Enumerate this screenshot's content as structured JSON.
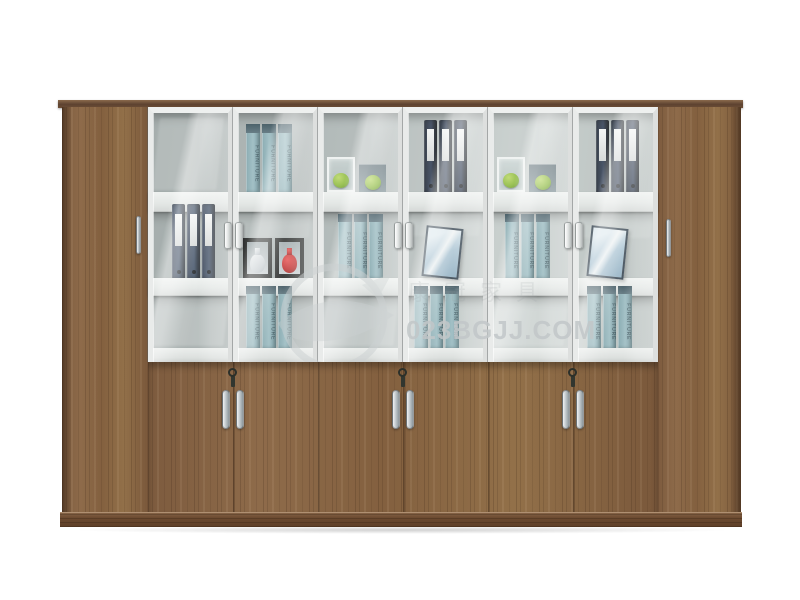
{
  "scene": {
    "description": "Walnut office wall cabinet with white-framed glass display doors, full-height wooden side doors, lower wooden double-door cupboards and a plinth base, photographed on a white background",
    "background_color": "#ffffff"
  },
  "watermark": {
    "site_text": "023BGJJ.COM",
    "cn_text": "康冠家具",
    "logo": "swoosh-circle-logo",
    "color": "#c2c7c9"
  },
  "labels": {
    "box_spine": "FURNITURE"
  },
  "colors": {
    "wood": "#86633f",
    "wood_dark": "#5d4230",
    "frame_white": "#eef0ef",
    "glass_tint": "#d0dad9",
    "interior_back": "#aab1b1",
    "binder_navy": "#202b42",
    "binder_black": "#131a28",
    "box_teal": "#87aab2",
    "apple_green": "#8cbb35",
    "vase_red": "#c02020",
    "vase_white": "#f4f6f8",
    "chrome": "#c2c9cd"
  },
  "structure": {
    "glass_door_bounds": [
      148,
      233,
      318,
      403,
      488,
      573,
      658
    ],
    "glass_handle_seams": [
      233,
      403,
      573
    ],
    "bottom_handle_seams": [
      233,
      403,
      573
    ],
    "wood_seams": [
      233,
      318,
      403,
      488,
      573
    ],
    "side_handles": [
      {
        "x": 136,
        "y": 216
      },
      {
        "x": 666,
        "y": 219
      }
    ],
    "shelf_rows": 3,
    "glass_doors": 6,
    "lower_door_pairs": 3
  },
  "items": [
    {
      "type": "boxes",
      "n": 3,
      "x": 246,
      "y": 124,
      "w": 46,
      "h": 68
    },
    {
      "type": "cup-apple",
      "x": 327,
      "y": 157,
      "w": 28,
      "h": 35
    },
    {
      "type": "coaster-apple",
      "x": 359,
      "y": 164,
      "w": 27,
      "h": 28
    },
    {
      "type": "binders",
      "variant": "black",
      "x": 424,
      "y": 120,
      "w": 43,
      "h": 72
    },
    {
      "type": "cup-apple",
      "x": 497,
      "y": 157,
      "w": 28,
      "h": 35
    },
    {
      "type": "coaster-apple",
      "x": 529,
      "y": 164,
      "w": 27,
      "h": 28
    },
    {
      "type": "binders",
      "variant": "black",
      "x": 596,
      "y": 120,
      "w": 43,
      "h": 72
    },
    {
      "type": "binders",
      "variant": "navy",
      "x": 172,
      "y": 204,
      "w": 43,
      "h": 74
    },
    {
      "type": "vase",
      "variant": "white",
      "x": 243,
      "y": 238,
      "w": 29,
      "h": 40
    },
    {
      "type": "vase",
      "variant": "red",
      "x": 275,
      "y": 238,
      "w": 29,
      "h": 40
    },
    {
      "type": "boxes",
      "n": 3,
      "x": 338,
      "y": 214,
      "w": 45,
      "h": 64
    },
    {
      "type": "frame",
      "x": 424,
      "y": 227,
      "w": 37,
      "h": 51
    },
    {
      "type": "boxes",
      "n": 3,
      "x": 505,
      "y": 214,
      "w": 45,
      "h": 64
    },
    {
      "type": "frame",
      "x": 589,
      "y": 227,
      "w": 37,
      "h": 51
    },
    {
      "type": "boxes",
      "n": 3,
      "x": 246,
      "y": 286,
      "w": 46,
      "h": 62
    },
    {
      "type": "boxes",
      "n": 3,
      "x": 414,
      "y": 286,
      "w": 45,
      "h": 62
    },
    {
      "type": "boxes",
      "n": 3,
      "x": 587,
      "y": 286,
      "w": 45,
      "h": 62
    }
  ],
  "reflections": [
    {
      "x": 156,
      "y": 118,
      "w": 64,
      "h": 72,
      "o": 0.38
    },
    {
      "x": 154,
      "y": 298,
      "w": 72,
      "h": 48,
      "o": 0.5
    },
    {
      "x": 324,
      "y": 298,
      "w": 72,
      "h": 48,
      "o": 0.45
    },
    {
      "x": 494,
      "y": 298,
      "w": 72,
      "h": 48,
      "o": 0.45
    },
    {
      "x": 236,
      "y": 214,
      "w": 74,
      "h": 24,
      "o": 0.3
    },
    {
      "x": 410,
      "y": 214,
      "w": 70,
      "h": 22,
      "o": 0.3
    },
    {
      "x": 580,
      "y": 214,
      "w": 72,
      "h": 24,
      "o": 0.3
    }
  ]
}
